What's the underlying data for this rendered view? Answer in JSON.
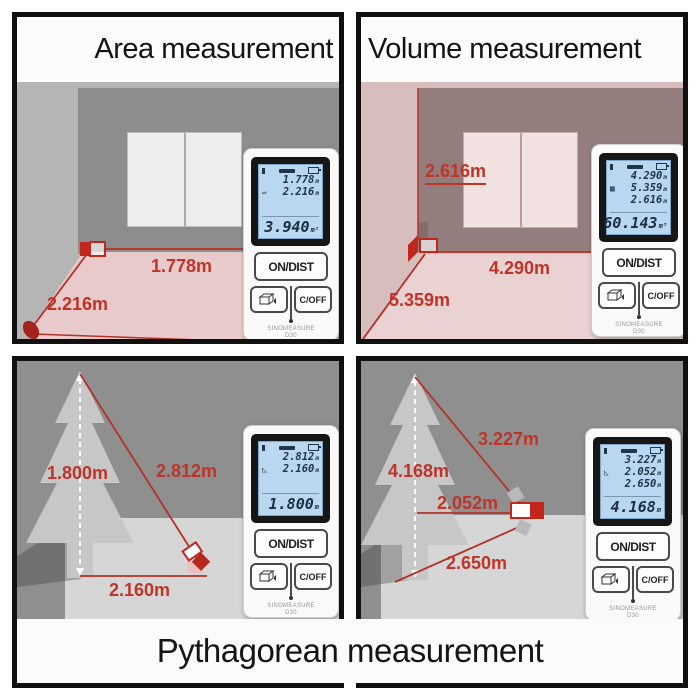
{
  "titles": {
    "bottom": "Pythagorean measurement"
  },
  "colors": {
    "accent_red": "#bf3428",
    "line_red": "#b23228",
    "lcd_blue": "#b9d7ef",
    "wall_gray": "#b5b5b5",
    "dark_bg": "#8f8f8f"
  },
  "quads": {
    "tl": {
      "title": "Area measurement",
      "labels": {
        "side_a": "1.778m",
        "side_b": "2.216m"
      },
      "device": {
        "rows": [
          "1.778",
          "2.216",
          ""
        ],
        "row_units": [
          "m",
          "m",
          ""
        ],
        "result": "3.940",
        "result_unit": "m²",
        "mode_icon": "▱",
        "btn_on": "ON/DIST",
        "btn_off": "C/OFF",
        "brand": "SINOMEASURE",
        "model": "D30"
      }
    },
    "tr": {
      "title": "Volume measurement",
      "labels": {
        "height": "2.616m",
        "width": "4.290m",
        "depth": "5.359m"
      },
      "device": {
        "rows": [
          "4.290",
          "5.359",
          "2.616"
        ],
        "row_units": [
          "m",
          "m",
          "m"
        ],
        "result": "60.143",
        "result_unit": "m³",
        "mode_icon": "▦",
        "btn_on": "ON/DIST",
        "btn_off": "C/OFF",
        "brand": "SINOMEASURE",
        "model": "D30"
      }
    },
    "bl": {
      "labels": {
        "height": "1.800m",
        "hypotenuse": "2.812m",
        "base": "2.160m"
      },
      "device": {
        "rows": [
          "2.812",
          "2.160",
          ""
        ],
        "row_units": [
          "m",
          "m",
          ""
        ],
        "result": "1.800",
        "result_unit": "m",
        "mode_icon": "◺",
        "btn_on": "ON/DIST",
        "btn_off": "C/OFF",
        "brand": "SINOMEASURE",
        "model": "D30"
      }
    },
    "br": {
      "labels": {
        "hypotenuse_top": "3.227m",
        "height": "4.168m",
        "middle": "2.052m",
        "hypotenuse_bottom": "2.650m"
      },
      "device": {
        "rows": [
          "3.227",
          "2.052",
          "2.650"
        ],
        "row_units": [
          "m",
          "m",
          "m"
        ],
        "result": "4.168",
        "result_unit": "m",
        "mode_icon": "◺",
        "btn_on": "ON/DIST",
        "btn_off": "C/OFF",
        "brand": "SINOMEASURE",
        "model": "D30"
      }
    }
  }
}
